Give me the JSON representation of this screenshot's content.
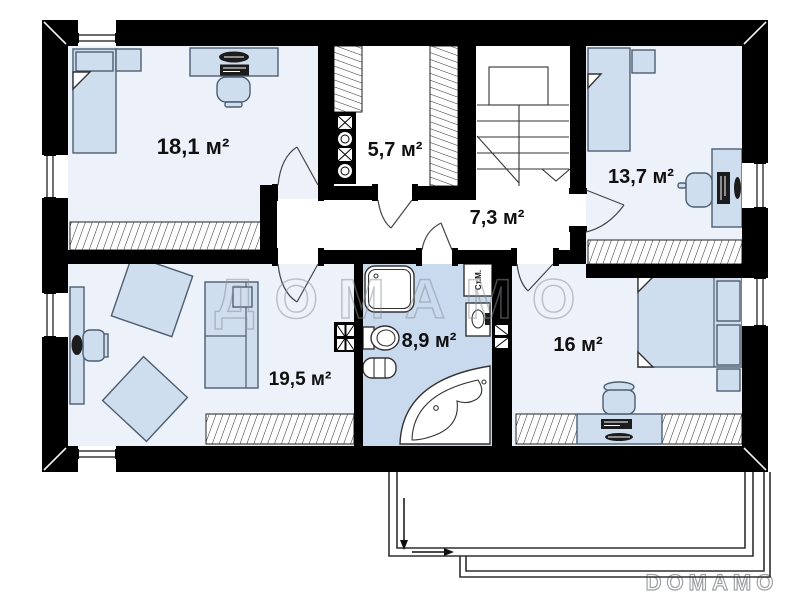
{
  "plan": {
    "rooms": {
      "bedroom_top_left": {
        "label": "18,1 м²"
      },
      "closet": {
        "label": "5,7 м²"
      },
      "hallway": {
        "label": "7,3 м²"
      },
      "bedroom_top_right": {
        "label": "13,7 м²"
      },
      "bathroom": {
        "label": "8,9 м²"
      },
      "room_bottom_left": {
        "label": "19,5 м²"
      },
      "bedroom_bottom_right": {
        "label": "16 м²"
      }
    },
    "labels": {
      "washing_machine": "Ст.М."
    },
    "watermark": {
      "center": "ДОМАМО",
      "corner": "DOMAMO"
    },
    "colors": {
      "wall": "#000000",
      "room_fill": "#edf2fa",
      "bathroom_fill": "#c9d9ee",
      "furniture_fill": "#cfdeef",
      "furniture_stroke": "#4d5d70",
      "watermark": "#8b9095"
    }
  }
}
